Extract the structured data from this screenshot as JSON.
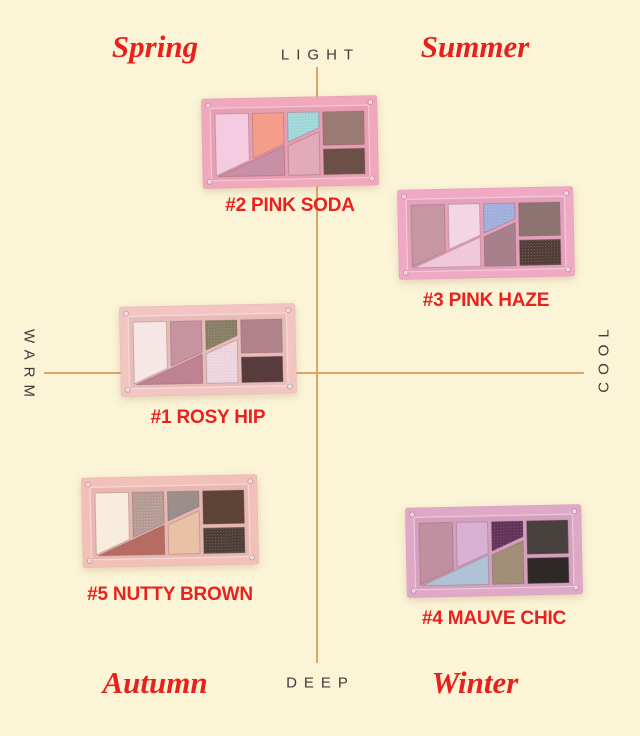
{
  "colors": {
    "background": "#FBF4D6",
    "axis_line": "#DCA566",
    "axis_label": "#3F3B38",
    "season_label": "#E8211D",
    "palette_label": "#E8231F"
  },
  "axes": {
    "top": "LIGHT",
    "bottom": "DEEP",
    "left": "WARM",
    "right": "COOL"
  },
  "seasons": {
    "top_left": "Spring",
    "top_right": "Summer",
    "bottom_left": "Autumn",
    "bottom_right": "Winter"
  },
  "palettes": [
    {
      "name": "pink-soda",
      "label": "#2 PINK SODA",
      "case_color": "#F1A7BC",
      "swatches": [
        {
          "color": "#F5CBE1",
          "glitter": false
        },
        {
          "color": "#F49D88",
          "glitter": false
        },
        {
          "color": "#9ED8DB",
          "glitter": true
        },
        {
          "color": "#9B7A72",
          "glitter": false
        },
        {
          "color": "#C98FA5",
          "glitter": false
        },
        {
          "color": "#E2AABB",
          "glitter": false
        },
        {
          "color": "#6A5047",
          "glitter": false
        }
      ]
    },
    {
      "name": "pink-haze",
      "label": "#3 PINK HAZE",
      "case_color": "#EFA9C4",
      "swatches": [
        {
          "color": "#C697A2",
          "glitter": false
        },
        {
          "color": "#F3D6E4",
          "glitter": false
        },
        {
          "color": "#9FAEDC",
          "glitter": true
        },
        {
          "color": "#8D7371",
          "glitter": false
        },
        {
          "color": "#EFC8DB",
          "glitter": false
        },
        {
          "color": "#A8808C",
          "glitter": false
        },
        {
          "color": "#4E3833",
          "glitter": true
        }
      ]
    },
    {
      "name": "rosy-hip",
      "label": "#1 ROSY HIP",
      "case_color": "#F2C5C2",
      "swatches": [
        {
          "color": "#F7E6E6",
          "glitter": false
        },
        {
          "color": "#C7939F",
          "glitter": false
        },
        {
          "color": "#847B61",
          "glitter": true
        },
        {
          "color": "#B0838A",
          "glitter": false
        },
        {
          "color": "#BE8293",
          "glitter": false
        },
        {
          "color": "#EED5DF",
          "glitter": true
        },
        {
          "color": "#573B3D",
          "glitter": false
        }
      ]
    },
    {
      "name": "nutty-brown",
      "label": "#5 NUTTY BROWN",
      "case_color": "#F2C0B9",
      "swatches": [
        {
          "color": "#F8EDDC",
          "glitter": false
        },
        {
          "color": "#B49A92",
          "glitter": true
        },
        {
          "color": "#9B8F8C",
          "glitter": false
        },
        {
          "color": "#5D4236",
          "glitter": false
        },
        {
          "color": "#B66C62",
          "glitter": false
        },
        {
          "color": "#E9C1A5",
          "glitter": false
        },
        {
          "color": "#493931",
          "glitter": true
        }
      ]
    },
    {
      "name": "mauve-chic",
      "label": "#4 MAUVE CHIC",
      "case_color": "#DFA8C6",
      "swatches": [
        {
          "color": "#C08FA0",
          "glitter": false
        },
        {
          "color": "#D8B0D4",
          "glitter": false
        },
        {
          "color": "#5E2D55",
          "glitter": true
        },
        {
          "color": "#48403C",
          "glitter": false
        },
        {
          "color": "#AFC3D4",
          "glitter": false
        },
        {
          "color": "#A28E77",
          "glitter": false
        },
        {
          "color": "#2F2829",
          "glitter": false
        }
      ]
    }
  ]
}
